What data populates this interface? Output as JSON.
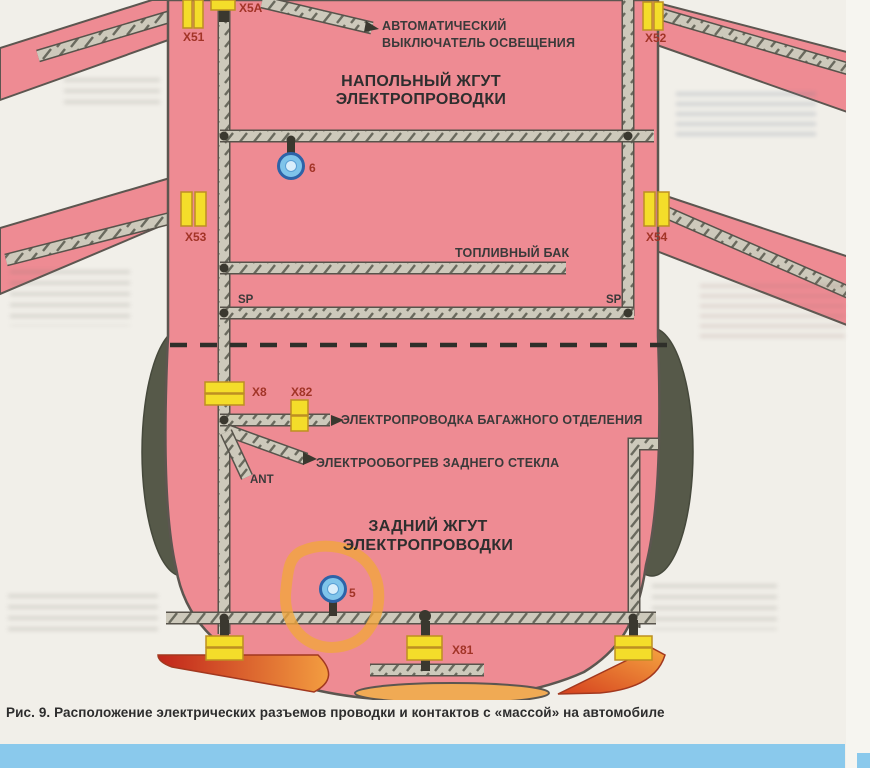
{
  "page": {
    "caption": "Рис. 9. Расположение электрических разъемов проводки и контактов с «массой» на автомобиле"
  },
  "diagram": {
    "headings": {
      "floor_harness_1": "НАПОЛЬНЫЙ ЖГУТ",
      "floor_harness_2": "ЭЛЕКТРОПРОВОДКИ",
      "rear_harness_1": "ЗАДНИЙ ЖГУТ",
      "rear_harness_2": "ЭЛЕКТРОПРОВОДКИ"
    },
    "labels": {
      "auto_light_switch_1": "АВТОМАТИЧЕСКИЙ",
      "auto_light_switch_2": "ВЫКЛЮЧАТЕЛЬ ОСВЕЩЕНИЯ",
      "fuel_tank": "ТОПЛИВНЫЙ БАК",
      "trunk_wiring": "ЭЛЕКТРОПРОВОДКА БАГАЖНОГО ОТДЕЛЕНИЯ",
      "rear_window_heater": "ЭЛЕКТРООБОГРЕВ ЗАДНЕГО СТЕКЛА",
      "antenna": "ANT",
      "splice_left": "SP",
      "splice_right": "SP"
    },
    "connectors": {
      "x51": "X51",
      "x5a": "X5A",
      "x52": "X52",
      "x53": "X53",
      "x54": "X54",
      "x8": "X8",
      "x82": "X82",
      "x81": "X81"
    },
    "ground_contacts": {
      "floor": "6",
      "rear": "5"
    },
    "colors": {
      "body_pink": "#ee8b93",
      "connector_yellow": "#f4dd2a",
      "ground_contact_blue": "#7fc4ea",
      "highlight_marker_orange": "#f2a63c",
      "connector_label_red": "#a23427",
      "footer_bar_blue": "#8ac9ec"
    }
  }
}
